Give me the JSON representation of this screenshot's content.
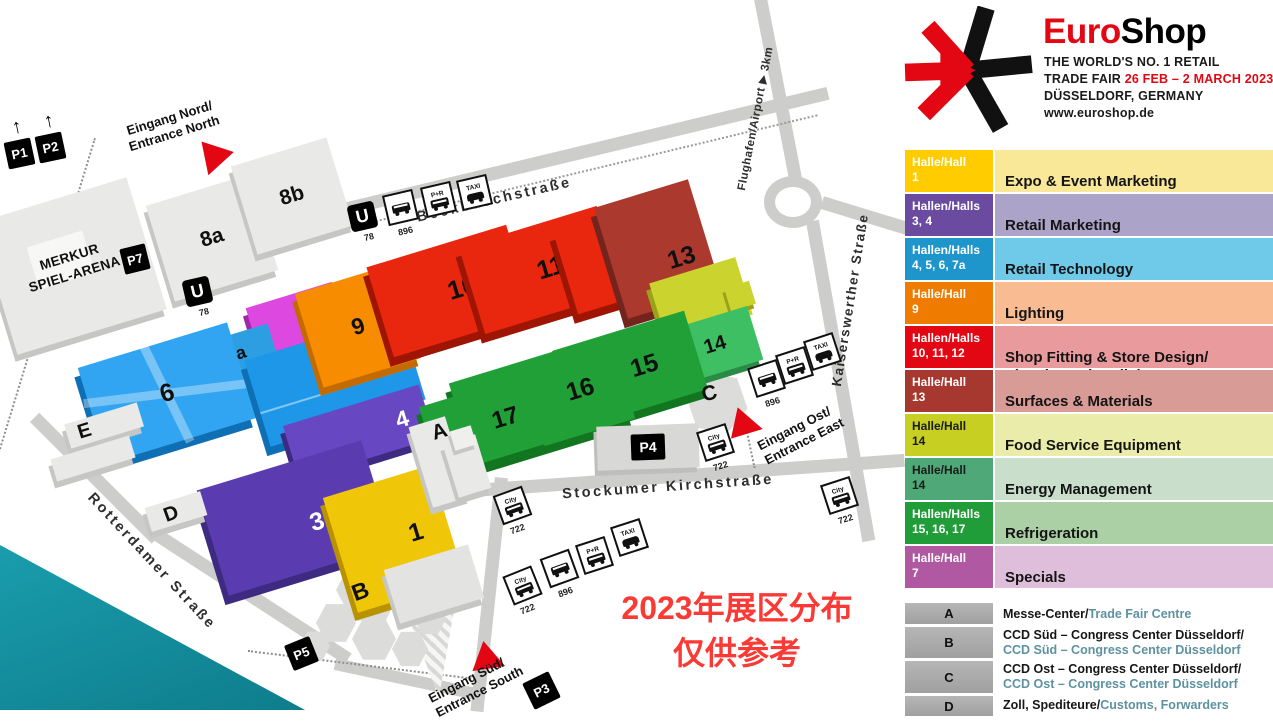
{
  "header": {
    "title_red": "Euro",
    "title_black": "Shop",
    "line1": "THE WORLD'S NO. 1 RETAIL",
    "line2_black": "TRADE FAIR ",
    "line2_red": "26 FEB – 2 MARCH 2023",
    "line3": "DÜSSELDORF, GERMANY",
    "line4": "www.euroshop.de"
  },
  "legend": {
    "rows": [
      {
        "hall_label": "Halle/Hall",
        "hall_numbers": "1",
        "category": "Expo & Event Marketing",
        "left_color": "#FFCC00",
        "right_color": "#F8E897",
        "text_color": "#FFFFFF"
      },
      {
        "hall_label": "Hallen/Halls",
        "hall_numbers": "3, 4",
        "category": "Retail Marketing",
        "left_color": "#6A4B9F",
        "right_color": "#ACA3C9",
        "text_color": "#FFFFFF"
      },
      {
        "hall_label": "Hallen/Halls",
        "hall_numbers": "4, 5, 6, 7a",
        "category": "Retail Technology",
        "left_color": "#1E96CB",
        "right_color": "#6FC9E9",
        "text_color": "#FFFFFF"
      },
      {
        "hall_label": "Halle/Hall",
        "hall_numbers": "9",
        "category": "Lighting",
        "left_color": "#EF7C00",
        "right_color": "#F8BB92",
        "text_color": "#FFFFFF"
      },
      {
        "hall_label": "Hallen/Halls",
        "hall_numbers": "10, 11, 12",
        "category": "Shop Fitting & Store Design/\nVisual Merchandising",
        "left_color": "#E30613",
        "right_color": "#E99A9C",
        "text_color": "#FFFFFF"
      },
      {
        "hall_label": "Halle/Hall",
        "hall_numbers": "13",
        "category": "Surfaces & Materials",
        "left_color": "#A7382F",
        "right_color": "#D99B96",
        "text_color": "#FFFFFF"
      },
      {
        "hall_label": "Halle/Hall",
        "hall_numbers": "14",
        "category": "Food Service Equipment",
        "left_color": "#C6CF22",
        "right_color": "#EAEDAA",
        "text_color": "#1A1A1A"
      },
      {
        "hall_label": "Halle/Hall",
        "hall_numbers": "14",
        "category": "Energy Management",
        "left_color": "#4FA878",
        "right_color": "#C9DFCC",
        "text_color": "#1A1A1A"
      },
      {
        "hall_label": "Hallen/Halls",
        "hall_numbers": "15, 16, 17",
        "category": "Refrigeration",
        "left_color": "#209C38",
        "right_color": "#ABD0A5",
        "text_color": "#FFFFFF"
      },
      {
        "hall_label": "Halle/Hall",
        "hall_numbers": "7",
        "category": "Specials",
        "left_color": "#B158A3",
        "right_color": "#DEBEDA",
        "text_color": "#FFFFFF"
      }
    ]
  },
  "facilities": [
    {
      "letter": "A",
      "de": "Messe-Center/",
      "en": "Trade Fair Centre"
    },
    {
      "letter": "B",
      "de": "CCD Süd – Congress Center Düsseldorf/",
      "en": "CCD Süd – Congress Center Düsseldorf"
    },
    {
      "letter": "C",
      "de": "CCD Ost – Congress Center Düsseldorf/",
      "en": "CCD Ost – Congress Center Düsseldorf"
    },
    {
      "letter": "D",
      "de": "Zoll, Spediteure/",
      "en": "Customs, Forwarders"
    }
  ],
  "map": {
    "halls": [
      {
        "label": "8a",
        "color": "#E9E9E7"
      },
      {
        "label": "8b",
        "color": "#E9E9E7"
      },
      {
        "label": "7",
        "color": "#DC48E0"
      },
      {
        "label": "7a",
        "color": "#2D9EE2"
      },
      {
        "label": "6",
        "color": "#32A5F2"
      },
      {
        "label": "5",
        "color": "#1E97E8"
      },
      {
        "label": "4",
        "color": "#6847C2"
      },
      {
        "label": "3",
        "color": "#5B3CB0"
      },
      {
        "label": "1",
        "color": "#EFC608"
      },
      {
        "label": "9",
        "color": "#F78C00"
      },
      {
        "label": "10",
        "color": "#E9260E"
      },
      {
        "label": "11",
        "color": "#E9260E"
      },
      {
        "label": "12",
        "color": "#E9260E"
      },
      {
        "label": "13",
        "color": "#AC392E"
      },
      {
        "label": "14",
        "color": "#3FBF63"
      },
      {
        "label": "15",
        "color": "#21A037"
      },
      {
        "label": "16",
        "color": "#21A037"
      },
      {
        "label": "17",
        "color": "#21A037"
      }
    ],
    "arena": "MERKUR\nSPIEL-ARENA",
    "letters": {
      "a": "A",
      "b": "B",
      "c": "C",
      "d": "D",
      "e": "E"
    },
    "streets": {
      "beckbusch": "Beckbuschstraße",
      "stockumer": "Stockumer Kirchstraße",
      "kaiserswerther": "Kaiserswerther Straße",
      "rotterdamer": "Rotterdamer Straße",
      "airport": "Flughafen/Airport ▶ 3km"
    },
    "entrances": {
      "north": "Eingang Nord/\nEntrance North",
      "east": "Eingang Ost/\nEntrance East",
      "south": "Eingang Süd/\nEntrance South"
    },
    "parking": {
      "p1": "P1",
      "p2": "P2",
      "p3": "P3",
      "p4": "P4",
      "p5": "P5",
      "p7": "P7"
    },
    "transit": {
      "u": "U",
      "line78": "78",
      "bus722": "722",
      "bus896": "896",
      "taxi": "TAXI",
      "pr": "P+R",
      "city": "City"
    },
    "annotation": "2023年展区分布\n仅供参考"
  },
  "colors": {
    "accent_red": "#E30613",
    "teal_corner": "#1795A5",
    "annotation_red": "#FB3A36",
    "facility_en_teal": "#5D92A0",
    "hall14_food_green": "#CBD32F"
  }
}
